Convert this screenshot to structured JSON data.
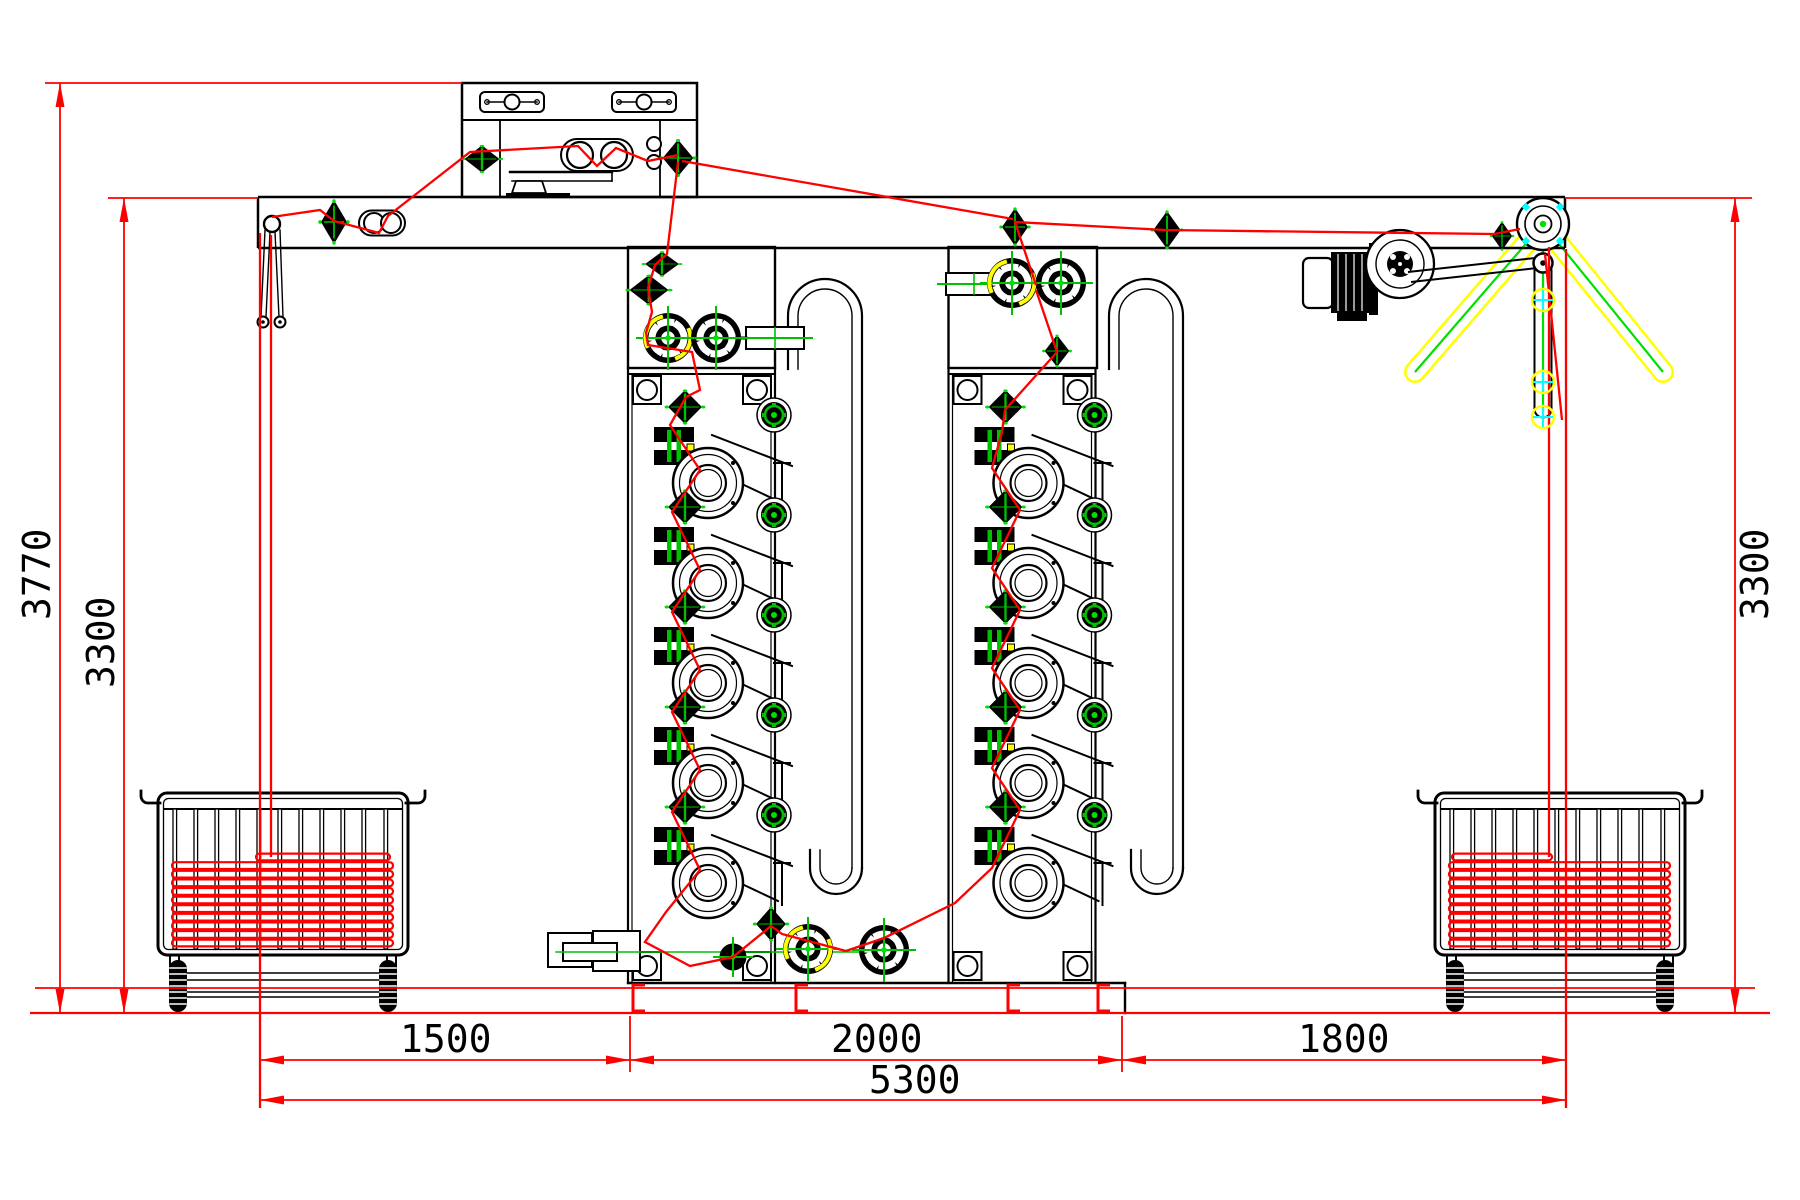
{
  "drawing": {
    "kind": "machine-elevation-cad",
    "dims": {
      "total_height": "3770",
      "left_height": "3300",
      "right_height": "3300",
      "bay_left_width": "1500",
      "towers_width": "2000",
      "bay_right_width": "1800",
      "total_width": "5300"
    },
    "colors": {
      "line": "#000000",
      "rope_and_dims": "#ff0000",
      "accent_green": "#00c000",
      "motion_yellow": "#ffff00",
      "marker_cyan": "#00ffff"
    },
    "components": {
      "overhead_beam": "overhead-beam",
      "feed_box": "top-feeder-box",
      "pendulum": "tension-pendulum",
      "tower_left": "wash-tower-1",
      "tower_right": "wash-tower-2",
      "u_pipe": "overflow-u-pipe",
      "squeeze_top_left": "squeeze-unit-tower1-top",
      "squeeze_top_right": "squeeze-unit-tower2-top",
      "squeeze_bottom": "squeeze-unit-bottom",
      "motor": "drive-motor",
      "winder": "winder-wheel",
      "swing_arm": "plaiting-swing-arm",
      "cart_left": "rope-cart-left",
      "cart_right": "rope-cart-right",
      "rope": "rope-path"
    }
  }
}
